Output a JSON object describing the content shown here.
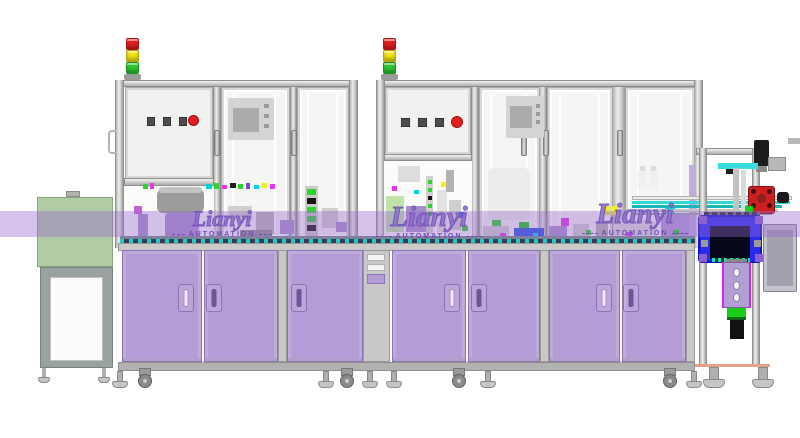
{
  "watermark": {
    "brand": "Lianyi",
    "subtitle": "AUTOMATION",
    "instances": 3
  },
  "palette": {
    "background": "#ffffff",
    "frame_aluminum": "#d9d9d7",
    "cabinet_purple": "#b49cd6",
    "cabinet_purple_dark": "#8d72b4",
    "watermark_purple": "#7b5cc0",
    "band_purple": "rgba(150,105,205,0.40)",
    "stack_light_red": "#e41e1e",
    "stack_light_yellow": "#f2e313",
    "stack_light_green": "#2fc832",
    "hood_green": "#a9c29a",
    "camera_box_blue": "#2b2bf0",
    "accent_green": "#19cf19",
    "accent_magenta": "#e833e8",
    "accent_cyan": "#00d5d5"
  }
}
